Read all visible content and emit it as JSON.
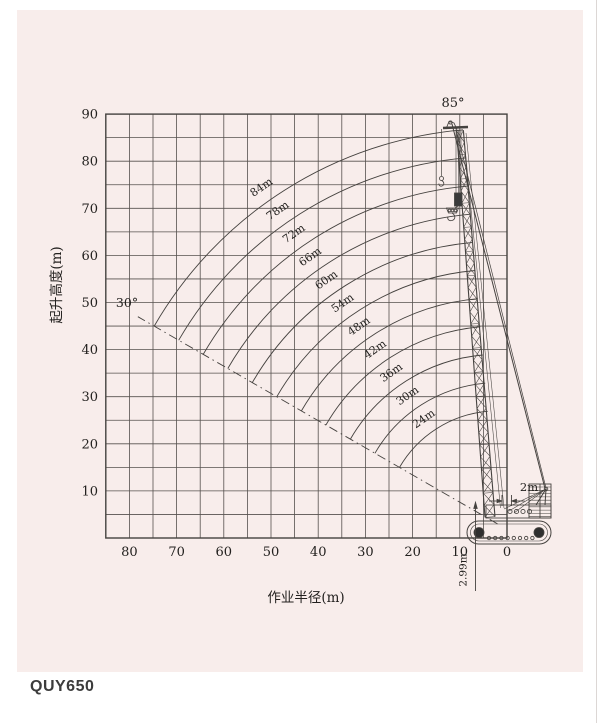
{
  "panel": {
    "background": "#f8edeb",
    "line_color": "#45423f",
    "text_color": "#23211f"
  },
  "footer": {
    "model": "QUY650"
  },
  "chart_data": {
    "type": "line",
    "title": "QUY650 crawler crane lifting height vs working radius range diagram",
    "xlabel": "作业半径(m)",
    "ylabel": "起升高度(m)",
    "x_ticks": [
      80,
      70,
      60,
      50,
      40,
      30,
      20,
      10,
      0
    ],
    "y_ticks": [
      10,
      20,
      30,
      40,
      50,
      60,
      70,
      80,
      90
    ],
    "xlim": [
      85,
      0
    ],
    "ylim": [
      0,
      90
    ],
    "x_axis_reversed": true,
    "grid": "on",
    "grid_step": 5,
    "boom_curves": {
      "lengths_m": [
        24,
        30,
        36,
        42,
        48,
        54,
        60,
        66,
        72,
        78,
        84
      ],
      "label_suffix": "m",
      "angle_min_deg": 30,
      "angle_max_deg": 85
    },
    "pivot": {
      "x_m": 2,
      "y_m": 2.99
    },
    "annotations": {
      "min_angle_label": "30°",
      "max_angle_label": "85°",
      "boom_foot_offset_label": "2m",
      "boom_foot_height_label": "2.99m"
    },
    "legend": "none"
  }
}
